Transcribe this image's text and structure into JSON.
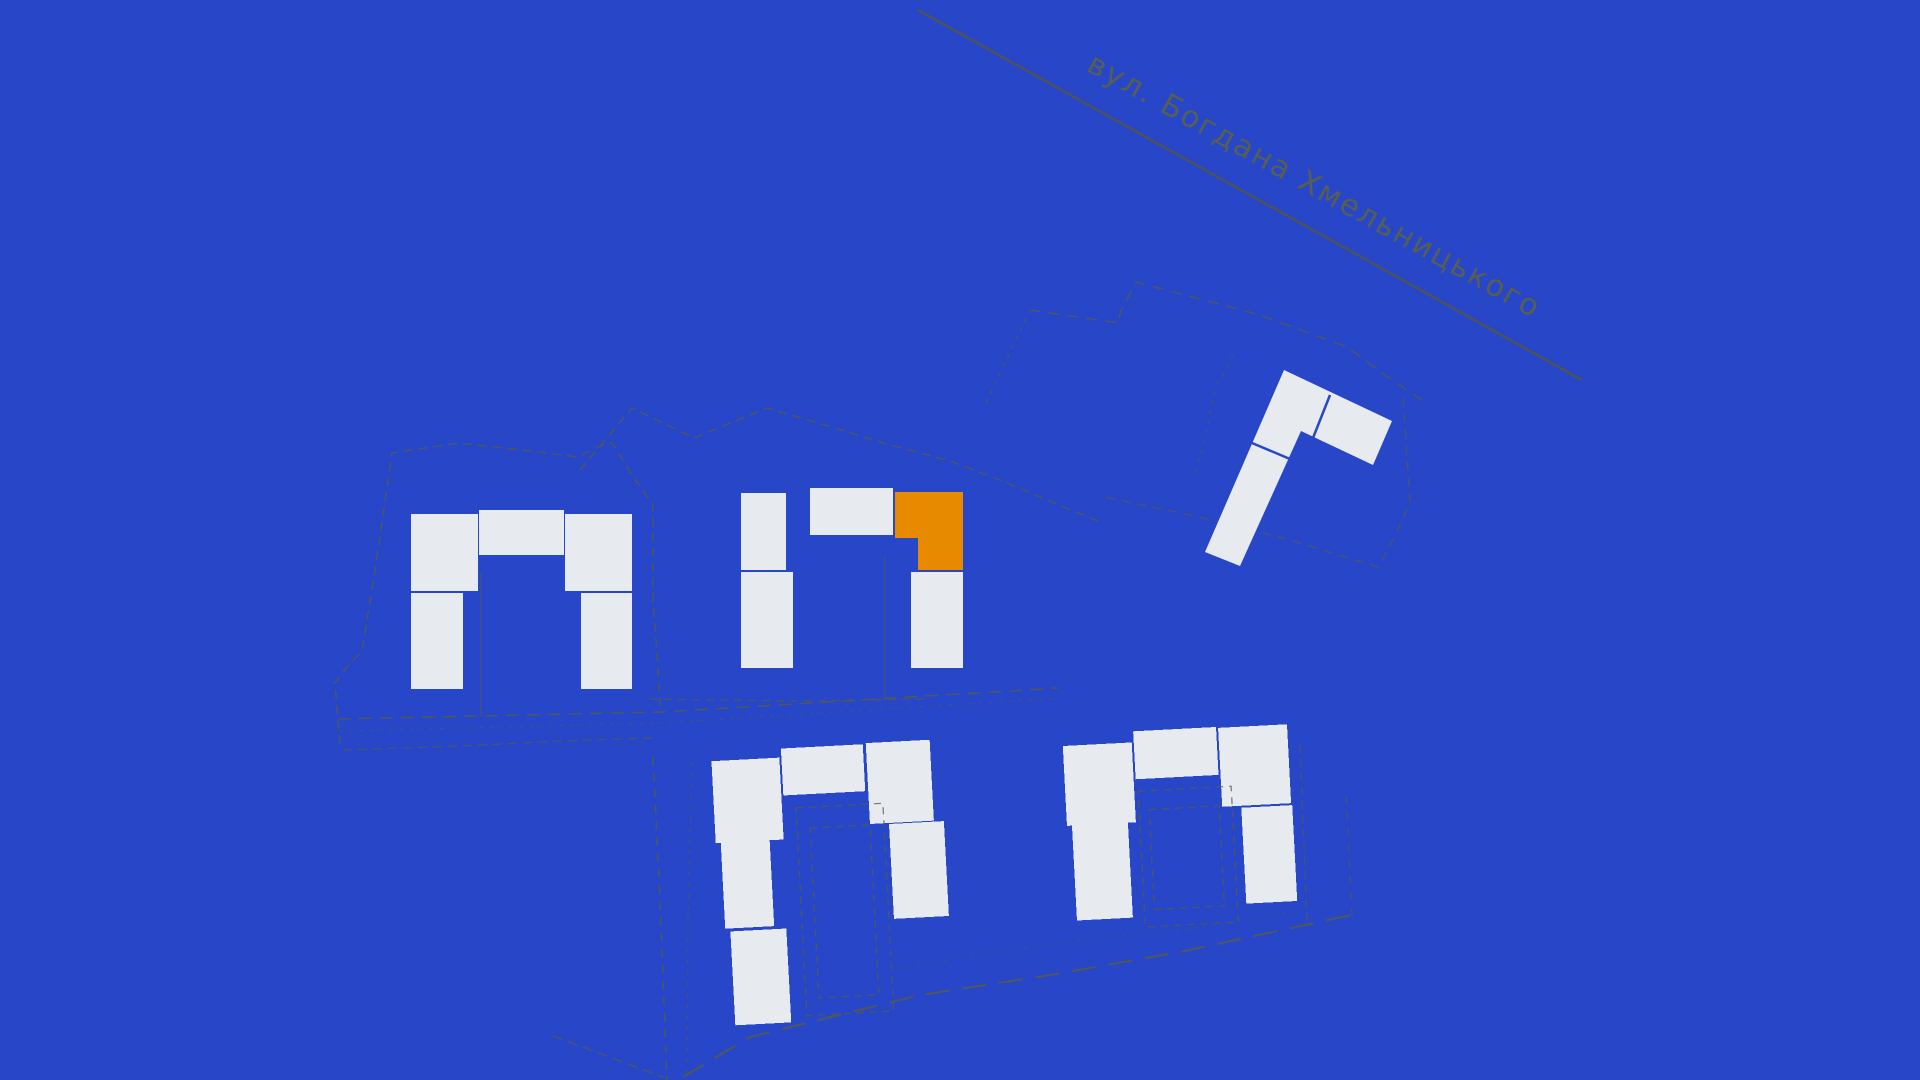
{
  "colors": {
    "background": "#2847C8",
    "building": "#E7EAEF",
    "highlight": "#E88A00",
    "boundary": "#585C45",
    "street_line": "#55573F",
    "split": "#2847C8"
  },
  "street": {
    "label": "вул. Богдана Хмельницького",
    "line": {
      "x1": 918,
      "y1": 10,
      "x2": 1582,
      "y2": 380,
      "width": 2.2,
      "opacity": 0.9
    },
    "label_x": 1085,
    "label_y": 70,
    "label_angle": 29,
    "font_size": 30
  },
  "map": {
    "clusters": [
      {
        "name": "west-building-group",
        "rotation": 0,
        "pivot": [
          521,
          600
        ],
        "blocks": [
          [
            411,
            514,
            67,
            77
          ],
          [
            479,
            510,
            85,
            45
          ],
          [
            565,
            514,
            67,
            77
          ],
          [
            411,
            593,
            52,
            96
          ],
          [
            581,
            593,
            51,
            96
          ]
        ],
        "dashed_rects": []
      },
      {
        "name": "central-building-group",
        "rotation": 0,
        "pivot": [
          852,
          578
        ],
        "blocks": [
          [
            741,
            493,
            45,
            77
          ],
          [
            810,
            488,
            83,
            47
          ],
          [
            741,
            572,
            52,
            96
          ],
          [
            911,
            572,
            52,
            96
          ]
        ],
        "dashed_rects": []
      },
      {
        "name": "south-building-group",
        "rotation": -3,
        "pivot": [
          833,
          883
        ],
        "blocks": [
          [
            718,
            755,
            68,
            82
          ],
          [
            788,
            746,
            82,
            47
          ],
          [
            873,
            745,
            64,
            81
          ],
          [
            892,
            827,
            55,
            95
          ],
          [
            723,
            837,
            49,
            86
          ],
          [
            728,
            926,
            56,
            94
          ]
        ],
        "dashed_rects": [
          [
            800,
            806,
            87,
            208
          ],
          [
            813,
            827,
            60,
            170
          ]
        ]
      },
      {
        "name": "southeast-building-group",
        "rotation": -3,
        "pivot": [
          1180,
          823
        ],
        "blocks": [
          [
            1067,
            740,
            69,
            80
          ],
          [
            1138,
            729,
            83,
            48
          ],
          [
            1223,
            730,
            69,
            79
          ],
          [
            1072,
            820,
            56,
            95
          ],
          [
            1242,
            811,
            51,
            96
          ]
        ],
        "dashed_rects": [
          [
            1140,
            789,
            93,
            136
          ],
          [
            1150,
            808,
            70,
            100
          ]
        ]
      }
    ],
    "highlight_building": {
      "points": "895,492 963,492 963,570 918,570 918,538 895,538"
    },
    "angled_building": {
      "outline": "1284,370 1392,421 1373,465 1301,431 1240,566 1205,552",
      "splits": [
        "1330,395 1313,438",
        "1252,443 1290,459"
      ]
    },
    "boundaries": [
      {
        "points": "340,744 335,683 347,667 362,651 374,577 392,453 458,443 540,452 577,457 600,446 612,443 636,481 653,505 653,597 661,713",
        "dash": "9 6",
        "width": 1.4,
        "opacity": 0.8
      },
      {
        "points": "338,719 662,712 1058,688",
        "dash": "13 8",
        "width": 1.5,
        "opacity": 0.8
      },
      {
        "points": "340,731 662,723 1058,698",
        "dash": "3 7",
        "width": 1.2,
        "opacity": 0.6
      },
      {
        "points": "343,750 460,746 560,741 652,738",
        "dash": "9 6",
        "width": 1.3,
        "opacity": 0.7
      },
      {
        "points": "653,757 660,900 667,1080",
        "dash": "9 7",
        "width": 1.4,
        "opacity": 0.8
      },
      {
        "points": "692,762 688,920 687,1077",
        "dash": "4 7",
        "width": 1.2,
        "opacity": 0.6
      },
      {
        "points": "683,1077 750,1037 920,995 1050,975 1180,952 1356,914",
        "dash": "24 13",
        "width": 2,
        "opacity": 0.85
      },
      {
        "points": "1352,916 1346,790",
        "dash": "9 7",
        "width": 1.3,
        "opacity": 0.6
      },
      {
        "points": "900,968 1063,942 1220,925 1303,910",
        "dash": "2 7",
        "width": 1.2,
        "opacity": 0.6
      },
      {
        "points": "1300,745 1307,925",
        "dash": "8 6",
        "width": 1.3,
        "opacity": 0.65
      },
      {
        "points": "580,470 632,408 694,438 767,408 832,427 883,443 950,461 1000,480 1047,500 1100,522",
        "dash": "9 6",
        "width": 1.4,
        "opacity": 0.8
      },
      {
        "points": "650,699 790,701 930,699",
        "dash": "8 6",
        "width": 1.3,
        "opacity": 0.7
      },
      {
        "points": "986,403 1030,310",
        "dash": "4 6",
        "width": 1.3,
        "opacity": 0.7
      },
      {
        "points": "1030,310 1119,323 1120,313 1136,282 1260,315 1347,347 1392,380 1428,404",
        "dash": "11 8",
        "width": 1.4,
        "opacity": 0.8
      },
      {
        "points": "1403,398 1410,503 1393,540 1378,567",
        "dash": "9 7",
        "width": 1.3,
        "opacity": 0.7
      },
      {
        "points": "1378,567 1290,540 1195,516 1105,497",
        "dash": "9 7",
        "width": 1.3,
        "opacity": 0.7
      },
      {
        "points": "1233,355 1215,390 1203,447 1194,477",
        "dash": "4 6",
        "width": 1.2,
        "opacity": 0.6
      },
      {
        "points": "553,1036 610,1057 665,1078",
        "dash": "10 6",
        "width": 1.5,
        "opacity": 0.75
      }
    ],
    "interior_lines": [
      {
        "x1": 481,
        "y1": 571,
        "x2": 481,
        "y2": 717
      },
      {
        "x1": 885,
        "y1": 556,
        "x2": 885,
        "y2": 700
      }
    ]
  }
}
